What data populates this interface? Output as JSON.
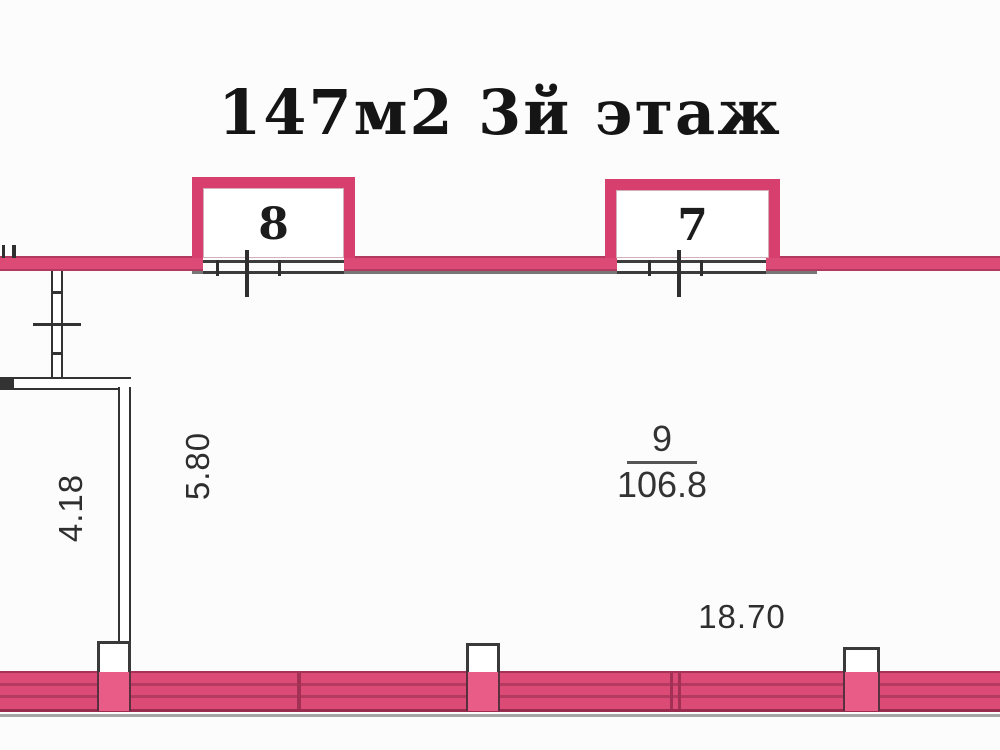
{
  "title": "147м2 3й этаж",
  "balconies": {
    "left": {
      "number": "8"
    },
    "right": {
      "number": "7"
    }
  },
  "main_room": {
    "number": "9",
    "area": "106.8"
  },
  "dimensions": {
    "inner_width": "5.80",
    "left_room_width": "4.18",
    "main_width": "18.70"
  },
  "colors": {
    "wall_pink": "#dc4b76",
    "wall_pink_dark": "#b23a61",
    "balcony_border": "#d63f6e",
    "column_pink": "#e95c87",
    "line_black": "#333333",
    "floor_gray": "#777777",
    "background": "#fcfcfc"
  }
}
